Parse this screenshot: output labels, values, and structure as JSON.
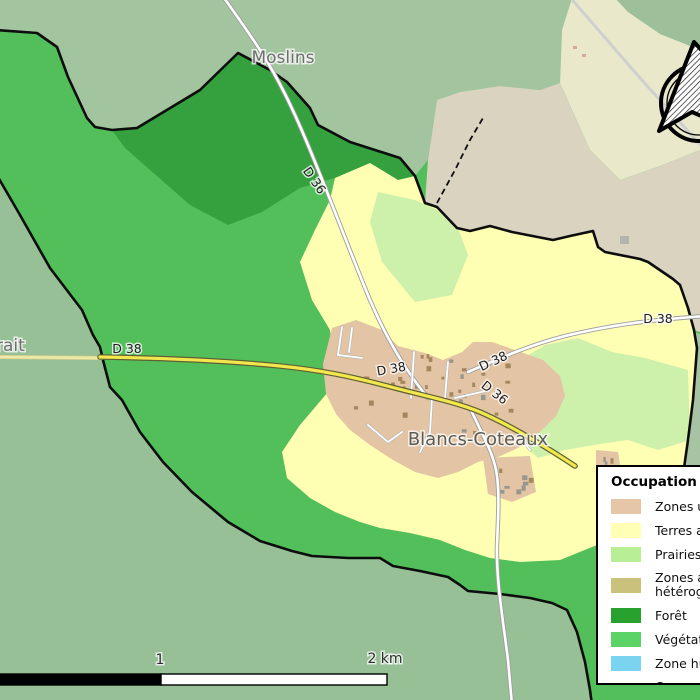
{
  "map": {
    "commune_name": "Blancs-Coteaux",
    "labels": [
      {
        "name": "place-label-moslins",
        "text": "Moslins",
        "x": 283,
        "y": 63,
        "size": 17,
        "color": "#6e6e6e",
        "rot": 0,
        "anchor": "middle",
        "bold": false
      },
      {
        "name": "place-label-partial-rait",
        "text": "rait",
        "x": -4,
        "y": 351,
        "size": 17,
        "color": "#6e6e6e",
        "rot": 0,
        "anchor": "start",
        "bold": false
      },
      {
        "name": "place-label-blancs-coteaux",
        "text": "Blancs-Coteaux",
        "x": 478,
        "y": 445,
        "size": 18,
        "color": "#5c5c52",
        "rot": 0,
        "anchor": "middle",
        "bold": false
      },
      {
        "name": "road-label-d36-north",
        "text": "D 36",
        "x": 311,
        "y": 183,
        "size": 12.5,
        "color": "#1c1c1c",
        "rot": 55,
        "anchor": "middle",
        "bold": false
      },
      {
        "name": "road-label-d38-west",
        "text": "D 38",
        "x": 127,
        "y": 353,
        "size": 12.5,
        "color": "#1c1c1c",
        "rot": 0,
        "anchor": "middle",
        "bold": false
      },
      {
        "name": "road-label-d38-village",
        "text": "D 38",
        "x": 392,
        "y": 373,
        "size": 12.5,
        "color": "#1c1c1c",
        "rot": -10,
        "anchor": "middle",
        "bold": false
      },
      {
        "name": "road-label-d38-east-diag",
        "text": "D 38",
        "x": 495,
        "y": 365,
        "size": 12.5,
        "color": "#1c1c1c",
        "rot": -25,
        "anchor": "middle",
        "bold": false
      },
      {
        "name": "road-label-d36-southeast",
        "text": "D 36",
        "x": 492,
        "y": 396,
        "size": 12.5,
        "color": "#1c1c1c",
        "rot": 38,
        "anchor": "middle",
        "bold": false
      },
      {
        "name": "road-label-d38-east",
        "text": "D 38",
        "x": 658,
        "y": 323,
        "size": 12.5,
        "color": "#1c1c1c",
        "rot": 0,
        "anchor": "middle",
        "bold": false
      },
      {
        "name": "scale-label-1",
        "text": "1",
        "x": 160,
        "y": 664,
        "size": 14,
        "color": "#2e2e2e",
        "rot": 0,
        "anchor": "middle",
        "bold": false
      },
      {
        "name": "scale-label-2km",
        "text": "2 km",
        "x": 385,
        "y": 663,
        "size": 14,
        "color": "#2e2e2e",
        "rot": 0,
        "anchor": "middle",
        "bold": false
      }
    ],
    "colors": {
      "commune_green": "#52bf5b",
      "forest_green": "#35a03e",
      "outside_green_nw": "#a2c49e",
      "outside_green_s": "#97c096",
      "outside_khaki_ne": "#e9e8cb",
      "outside_beige_ne": "#d9d3bf",
      "arable_yellow": "#ffffb3",
      "prairie_green": "#cdf0ab",
      "urban_tan": "#e3c4a4",
      "road_yellow": "#f2e84e",
      "boundary_black": "#0d0d0d"
    }
  },
  "legend": {
    "title": "Occupation des sols",
    "items": [
      {
        "label": "Zones urbanisées",
        "swatch": "#e5c6a6",
        "type": "fill"
      },
      {
        "label": "Terres arables",
        "swatch": "#ffffb5",
        "type": "fill"
      },
      {
        "label": "Prairies",
        "swatch": "#b7ee96",
        "type": "fill"
      },
      {
        "label": "Zones agricoles\nhétérogènes",
        "swatch": "#c9c17c",
        "type": "fill"
      },
      {
        "label": "Forêt",
        "swatch": "#28a12e",
        "type": "fill"
      },
      {
        "label": "Végétation arbustive",
        "swatch": "#5cd366",
        "type": "fill"
      },
      {
        "label": "Zone humide",
        "swatch": "#79d3f1",
        "type": "fill"
      },
      {
        "label": "Cours d'eau",
        "swatch": "#26269c",
        "type": "line"
      }
    ]
  },
  "scale_bar": {
    "mid_label": "1",
    "end_label": "2 km"
  }
}
